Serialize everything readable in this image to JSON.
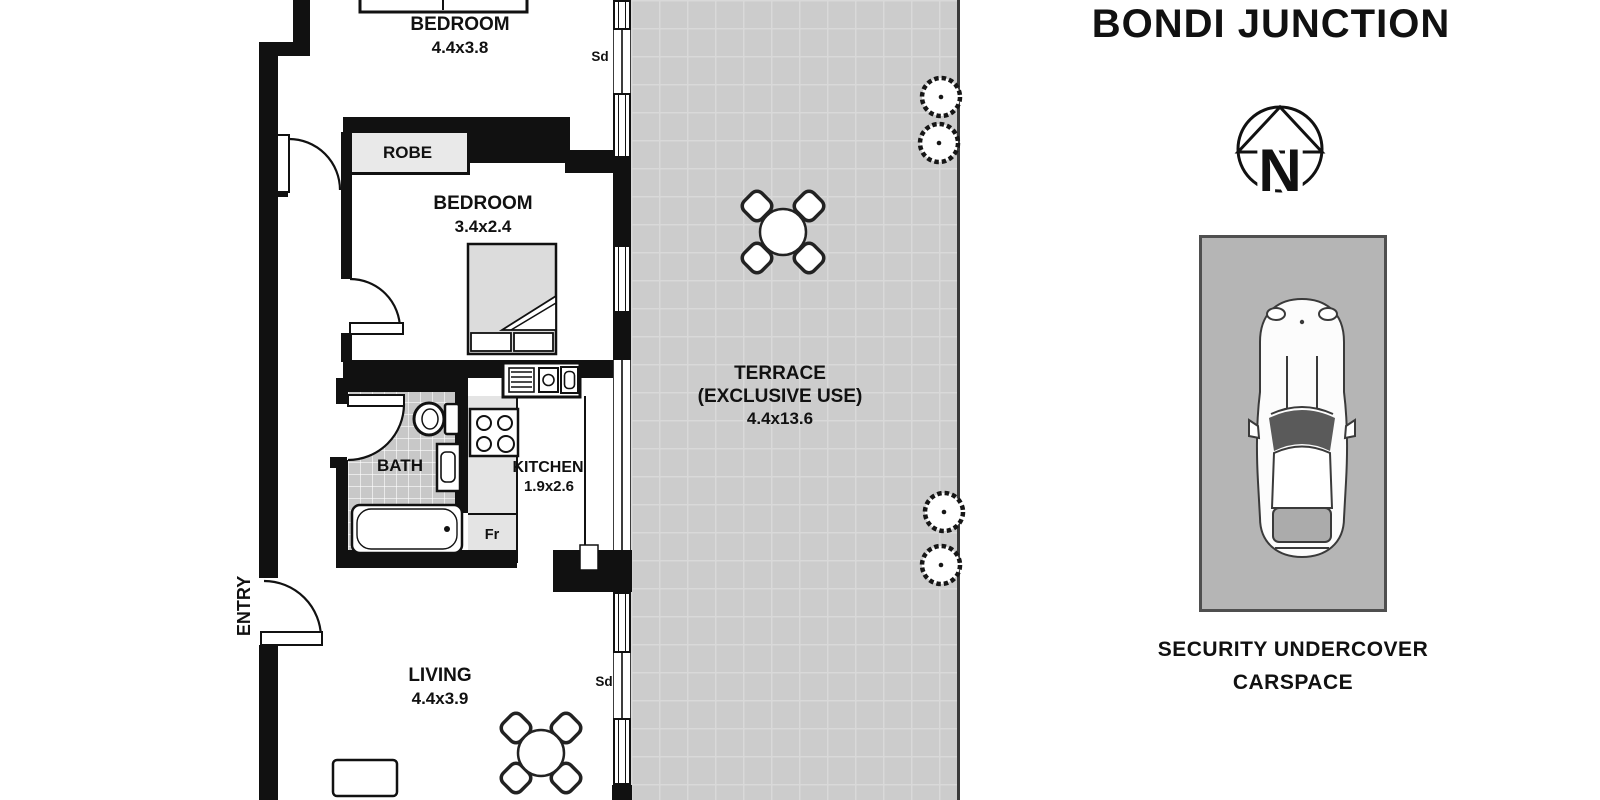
{
  "title": "BONDI JUNCTION",
  "compass": {
    "label": "N"
  },
  "rooms": {
    "bedroom1": {
      "name": "BEDROOM",
      "dims": "4.4x3.8"
    },
    "bedroom2": {
      "name": "BEDROOM",
      "dims": "3.4x2.4"
    },
    "robe": {
      "name": "ROBE"
    },
    "bath": {
      "name": "BATH"
    },
    "kitchen": {
      "name": "KITCHEN",
      "dims": "1.9x2.6"
    },
    "living": {
      "name": "LIVING",
      "dims": "4.4x3.9"
    },
    "terrace": {
      "name": "TERRACE",
      "subtitle": "(EXCLUSIVE USE)",
      "dims": "4.4x13.6"
    },
    "entry": {
      "name": "ENTRY"
    }
  },
  "markers": {
    "sliding_door_top": "Sd",
    "sliding_door_bottom": "Sd",
    "fridge": "Fr"
  },
  "carspace": {
    "line1": "SECURITY UNDERCOVER",
    "line2": "CARSPACE"
  },
  "colors": {
    "wall": "#111111",
    "terrace_fill": "#cccccc",
    "bath_tile": "#c8c8c8",
    "carspace_fill": "#b5b5b5",
    "robe_fill": "#e9e9e9",
    "counter_fill": "#e4e4e4",
    "bed_fill": "#dcdcdc",
    "boundary": "#3a3a3a"
  }
}
